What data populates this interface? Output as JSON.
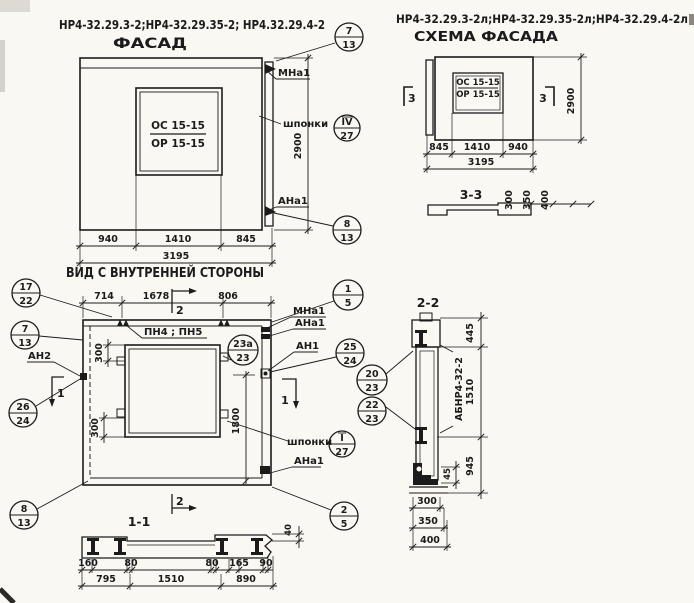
{
  "colors": {
    "ink": "#1b1b1b",
    "paper": "#f9f8f3"
  },
  "titles": {
    "facade_marks": "НР4-32.29.3-2;НР4-32.29.35-2; НР4.32.29.4-2",
    "facade": "ФАСАД",
    "schema_marks": "НР4-32.29.3-2л;НР4-32.29.35-2л;НР4-32.29.4-2л",
    "schema": "СХЕМА ФАСАДА",
    "inner_view": "ВИД С ВНУТРЕННЕЙ СТОРОНЫ",
    "section_1": "1-1",
    "section_2": "2-2",
    "section_3": "3-3"
  },
  "window_label": {
    "top": "ОС 15-15",
    "bottom": "ОР 15-15"
  },
  "facade": {
    "dim_left": "940",
    "dim_mid": "1410",
    "dim_right": "845",
    "dim_total": "3195",
    "dim_height": "2900",
    "label_mna1": "МНа1",
    "label_shponki": "шпонки",
    "label_ana1": "АНа1"
  },
  "schema": {
    "dim_left": "845",
    "dim_mid": "1410",
    "dim_right": "940",
    "dim_total": "3195",
    "dim_height": "2900",
    "marker": "3"
  },
  "section3": {
    "dim_300": "300",
    "dim_350": "350",
    "dim_400": "400"
  },
  "view": {
    "dim_top_left": "714",
    "dim_top_mid": "1678",
    "dim_top_right": "806",
    "dim_300": "300",
    "dim_1800": "1800",
    "dim_40": "40",
    "label_an2": "АН2",
    "label_pn": "ПН4 ; ПН5",
    "label_mna1": "МНа1",
    "label_ana1": "АНа1",
    "label_an1": "АН1",
    "label_shponki": "шпонки",
    "label_ana1_low": "АНа1",
    "marker_1": "1",
    "marker_2": "2"
  },
  "section1": {
    "dim_160": "160",
    "dim_80a": "80",
    "dim_80b": "80",
    "dim_165": "165",
    "dim_90": "90",
    "dim_795": "795",
    "dim_1510": "1510",
    "dim_890": "890"
  },
  "section2": {
    "label_block": "АБНР4-32-2",
    "dim_445": "445",
    "dim_1510": "1510",
    "dim_945": "945",
    "dim_45": "45",
    "dim_300": "300",
    "dim_350": "350",
    "dim_400": "400"
  },
  "balloons": [
    {
      "top": "7",
      "bottom": "13"
    },
    {
      "top": "IV",
      "bottom": "27"
    },
    {
      "top": "8",
      "bottom": "13"
    },
    {
      "top": "17",
      "bottom": "22"
    },
    {
      "top": "7",
      "bottom": "13"
    },
    {
      "top": "1",
      "bottom": "5"
    },
    {
      "top": "23а",
      "bottom": "23"
    },
    {
      "top": "25",
      "bottom": "24"
    },
    {
      "top": "26",
      "bottom": "24"
    },
    {
      "top": "20",
      "bottom": "23"
    },
    {
      "top": "22",
      "bottom": "23"
    },
    {
      "top": "8",
      "bottom": "13"
    },
    {
      "top": "I",
      "bottom": "27"
    },
    {
      "top": "2",
      "bottom": "5"
    }
  ]
}
